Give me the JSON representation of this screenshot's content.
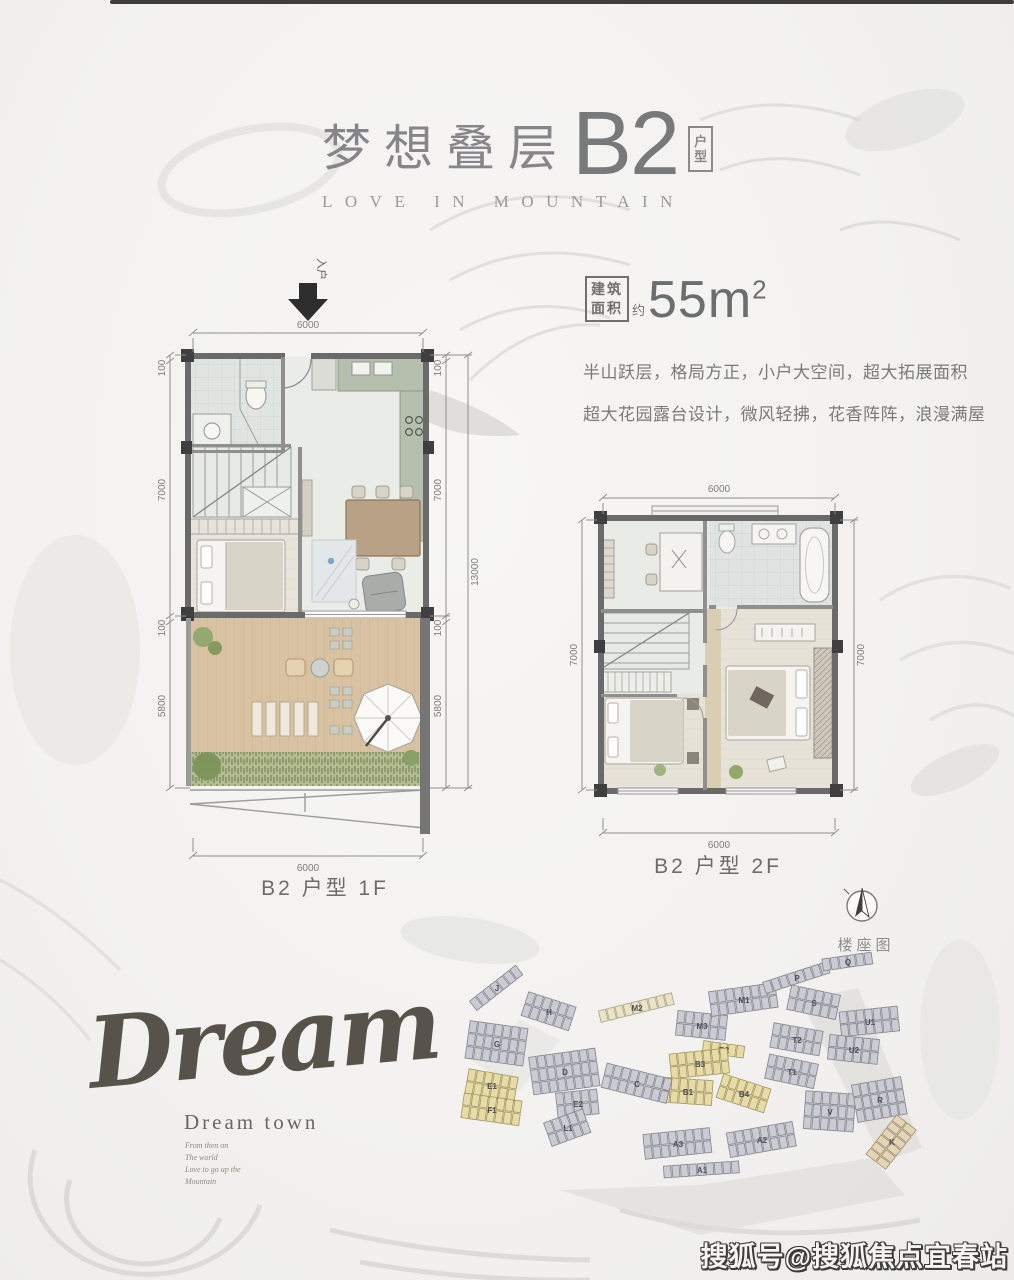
{
  "header": {
    "title_cn": "梦想叠层",
    "title_code": "B2",
    "tag": [
      "户",
      "型"
    ],
    "subtitle": "LOVE IN MOUNTAIN"
  },
  "area": {
    "box_top": "建筑",
    "box_bottom": "面积",
    "approx": "约",
    "value": "55m",
    "sup": "2"
  },
  "desc": {
    "line1": "半山跃层，格局方正，小户大空间，超大拓展面积",
    "line2": "超大花园露台设计，微风轻拂，花香阵阵，浪漫满屋"
  },
  "plan1": {
    "label": "B2 户型 1F",
    "entry": "入户",
    "dims": {
      "top": "6000",
      "bottom": "6000",
      "a": "100",
      "b": "7000",
      "c": "100",
      "d": "5800",
      "overall": "13000"
    }
  },
  "plan2": {
    "label": "B2 户型 2F",
    "dims": {
      "top": "6000",
      "bottom": "6000",
      "left": "7000",
      "right": "7000"
    }
  },
  "compass": {
    "label": "楼座图"
  },
  "dream": {
    "script": "Dream",
    "town": "Dream town",
    "lines": [
      "From then on",
      "The world",
      "Love to go up the",
      "Mountain"
    ]
  },
  "watermark": "搜狐号@搜狐焦点宜春站",
  "siteplan": {
    "colors": {
      "gray": {
        "fill": "#cbcbd3",
        "stroke": "#82828c"
      },
      "yellow": {
        "fill": "#e7dca6",
        "stroke": "#a2945c"
      },
      "cream": {
        "fill": "#eae3c6",
        "stroke": "#a9a183"
      },
      "tan": {
        "fill": "#e4d5b6",
        "stroke": "#a28f6a"
      }
    },
    "clusters": [
      {
        "label": "J",
        "x": 497,
        "y": 988,
        "rot": -38,
        "n": 7,
        "rows": 1,
        "color": "gray"
      },
      {
        "label": "H",
        "x": 549,
        "y": 1012,
        "rot": 18,
        "n": 6,
        "rows": 2,
        "color": "gray"
      },
      {
        "label": "G",
        "x": 497,
        "y": 1044,
        "rot": 8,
        "n": 7,
        "rows": 3,
        "color": "gray"
      },
      {
        "label": "M2",
        "x": 637,
        "y": 1008,
        "rot": -14,
        "n": 9,
        "rows": 1,
        "color": "cream"
      },
      {
        "label": "M3",
        "x": 702,
        "y": 1026,
        "rot": 6,
        "n": 6,
        "rows": 2,
        "color": "gray"
      },
      {
        "label": "M1",
        "x": 744,
        "y": 1000,
        "rot": -8,
        "n": 8,
        "rows": 2,
        "color": "gray"
      },
      {
        "label": "P",
        "x": 797,
        "y": 978,
        "rot": -18,
        "n": 8,
        "rows": 1,
        "color": "gray"
      },
      {
        "label": "Q",
        "x": 848,
        "y": 962,
        "rot": -8,
        "n": 6,
        "rows": 1,
        "color": "gray"
      },
      {
        "label": "S",
        "x": 814,
        "y": 1003,
        "rot": 12,
        "n": 6,
        "rows": 2,
        "color": "gray"
      },
      {
        "label": "T2",
        "x": 797,
        "y": 1040,
        "rot": 10,
        "n": 6,
        "rows": 2,
        "color": "gray"
      },
      {
        "label": "T1",
        "x": 792,
        "y": 1072,
        "rot": 12,
        "n": 6,
        "rows": 2,
        "color": "gray"
      },
      {
        "label": "U1",
        "x": 870,
        "y": 1022,
        "rot": -6,
        "n": 7,
        "rows": 2,
        "color": "gray"
      },
      {
        "label": "U2",
        "x": 854,
        "y": 1050,
        "rot": 6,
        "n": 6,
        "rows": 2,
        "color": "gray"
      },
      {
        "label": "V",
        "x": 830,
        "y": 1112,
        "rot": 4,
        "n": 6,
        "rows": 3,
        "color": "gray"
      },
      {
        "label": "R",
        "x": 880,
        "y": 1100,
        "rot": -10,
        "n": 6,
        "rows": 3,
        "color": "gray"
      },
      {
        "label": "K",
        "x": 892,
        "y": 1142,
        "rot": -52,
        "n": 6,
        "rows": 2,
        "color": "tan"
      },
      {
        "label": "B2",
        "x": 724,
        "y": 1050,
        "rot": 8,
        "n": 5,
        "rows": 1,
        "color": "yellow"
      },
      {
        "label": "B3",
        "x": 700,
        "y": 1064,
        "rot": -6,
        "n": 7,
        "rows": 2,
        "color": "yellow"
      },
      {
        "label": "B1",
        "x": 688,
        "y": 1092,
        "rot": 4,
        "n": 6,
        "rows": 2,
        "color": "yellow"
      },
      {
        "label": "B4",
        "x": 744,
        "y": 1094,
        "rot": 18,
        "n": 6,
        "rows": 2,
        "color": "yellow"
      },
      {
        "label": "C",
        "x": 637,
        "y": 1084,
        "rot": 14,
        "n": 8,
        "rows": 2,
        "color": "gray"
      },
      {
        "label": "D",
        "x": 565,
        "y": 1072,
        "rot": -8,
        "n": 8,
        "rows": 3,
        "color": "gray"
      },
      {
        "label": "E1",
        "x": 492,
        "y": 1086,
        "rot": 10,
        "n": 6,
        "rows": 2,
        "color": "yellow"
      },
      {
        "label": "F1",
        "x": 492,
        "y": 1110,
        "rot": 8,
        "n": 7,
        "rows": 2,
        "color": "yellow"
      },
      {
        "label": "E2",
        "x": 578,
        "y": 1104,
        "rot": -6,
        "n": 5,
        "rows": 2,
        "color": "gray"
      },
      {
        "label": "L1",
        "x": 568,
        "y": 1128,
        "rot": -20,
        "n": 5,
        "rows": 2,
        "color": "gray"
      },
      {
        "label": "A3",
        "x": 678,
        "y": 1144,
        "rot": -6,
        "n": 8,
        "rows": 2,
        "color": "gray"
      },
      {
        "label": "A2",
        "x": 762,
        "y": 1140,
        "rot": -10,
        "n": 8,
        "rows": 2,
        "color": "gray"
      },
      {
        "label": "A1",
        "x": 702,
        "y": 1170,
        "rot": -4,
        "n": 9,
        "rows": 1,
        "color": "gray"
      }
    ]
  }
}
